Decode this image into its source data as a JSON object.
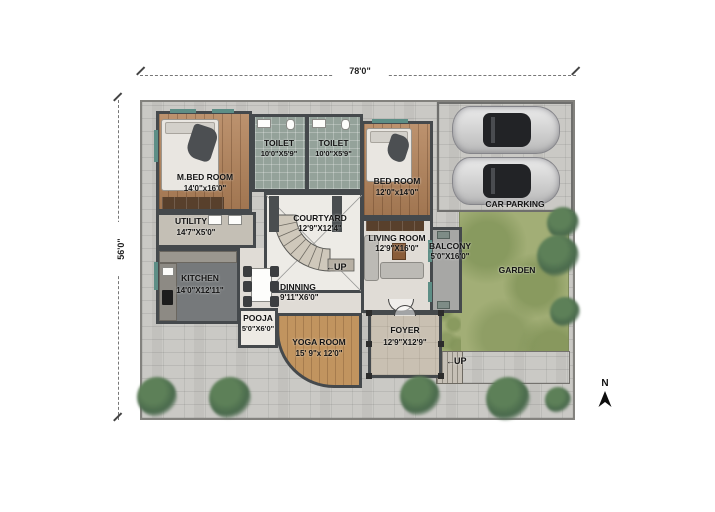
{
  "plan": {
    "dimensions": {
      "width": "78'0\"",
      "height": "56'0\""
    },
    "rooms": {
      "mbed": {
        "name": "M.BED ROOM",
        "size": "14'0\"x16'0\""
      },
      "toilet1": {
        "name": "TOILET",
        "size": "10'0\"X5'9\""
      },
      "toilet2": {
        "name": "TOILET",
        "size": "10'0\"X5'9\""
      },
      "bed": {
        "name": "BED ROOM",
        "size": "12'0\"x14'0\""
      },
      "carparking": {
        "name": "CAR PARKING"
      },
      "utility": {
        "name": "UTILITY",
        "size": "14'7\"X5'0\""
      },
      "courtyard": {
        "name": "COURTYARD",
        "size": "12'9\"X12'4\""
      },
      "living": {
        "name": "LIVING ROOM",
        "size": "12'9\"X16'0\""
      },
      "balcony": {
        "name": "BALCONY",
        "size": "5'0\"X16'0\""
      },
      "garden": {
        "name": "GARDEN"
      },
      "kitchen": {
        "name": "KITCHEN",
        "size": "14'0\"X12'11\""
      },
      "dinning": {
        "name": "DINNING",
        "size": "9'11\"X6'0\""
      },
      "pooja": {
        "name": "POOJA",
        "size": "5'0\"X6'0\""
      },
      "yoga": {
        "name": "YOGA ROOM",
        "size": "15' 9\"x 12'0\""
      },
      "foyer": {
        "name": "FOYER",
        "size": "12'9\"X12'9\""
      }
    },
    "annotations": {
      "up_stair": "UP",
      "up_entry": "UP",
      "north": "N"
    },
    "icons": {
      "arrow_left": "←"
    },
    "colors": {
      "wall": "#45494c",
      "window_accent": "#5d8e86",
      "wood_floor": "#b3835a",
      "garden_green": "#a2ae76",
      "tree_green": "#49694c",
      "stone_paving": "#cac9c5"
    }
  }
}
